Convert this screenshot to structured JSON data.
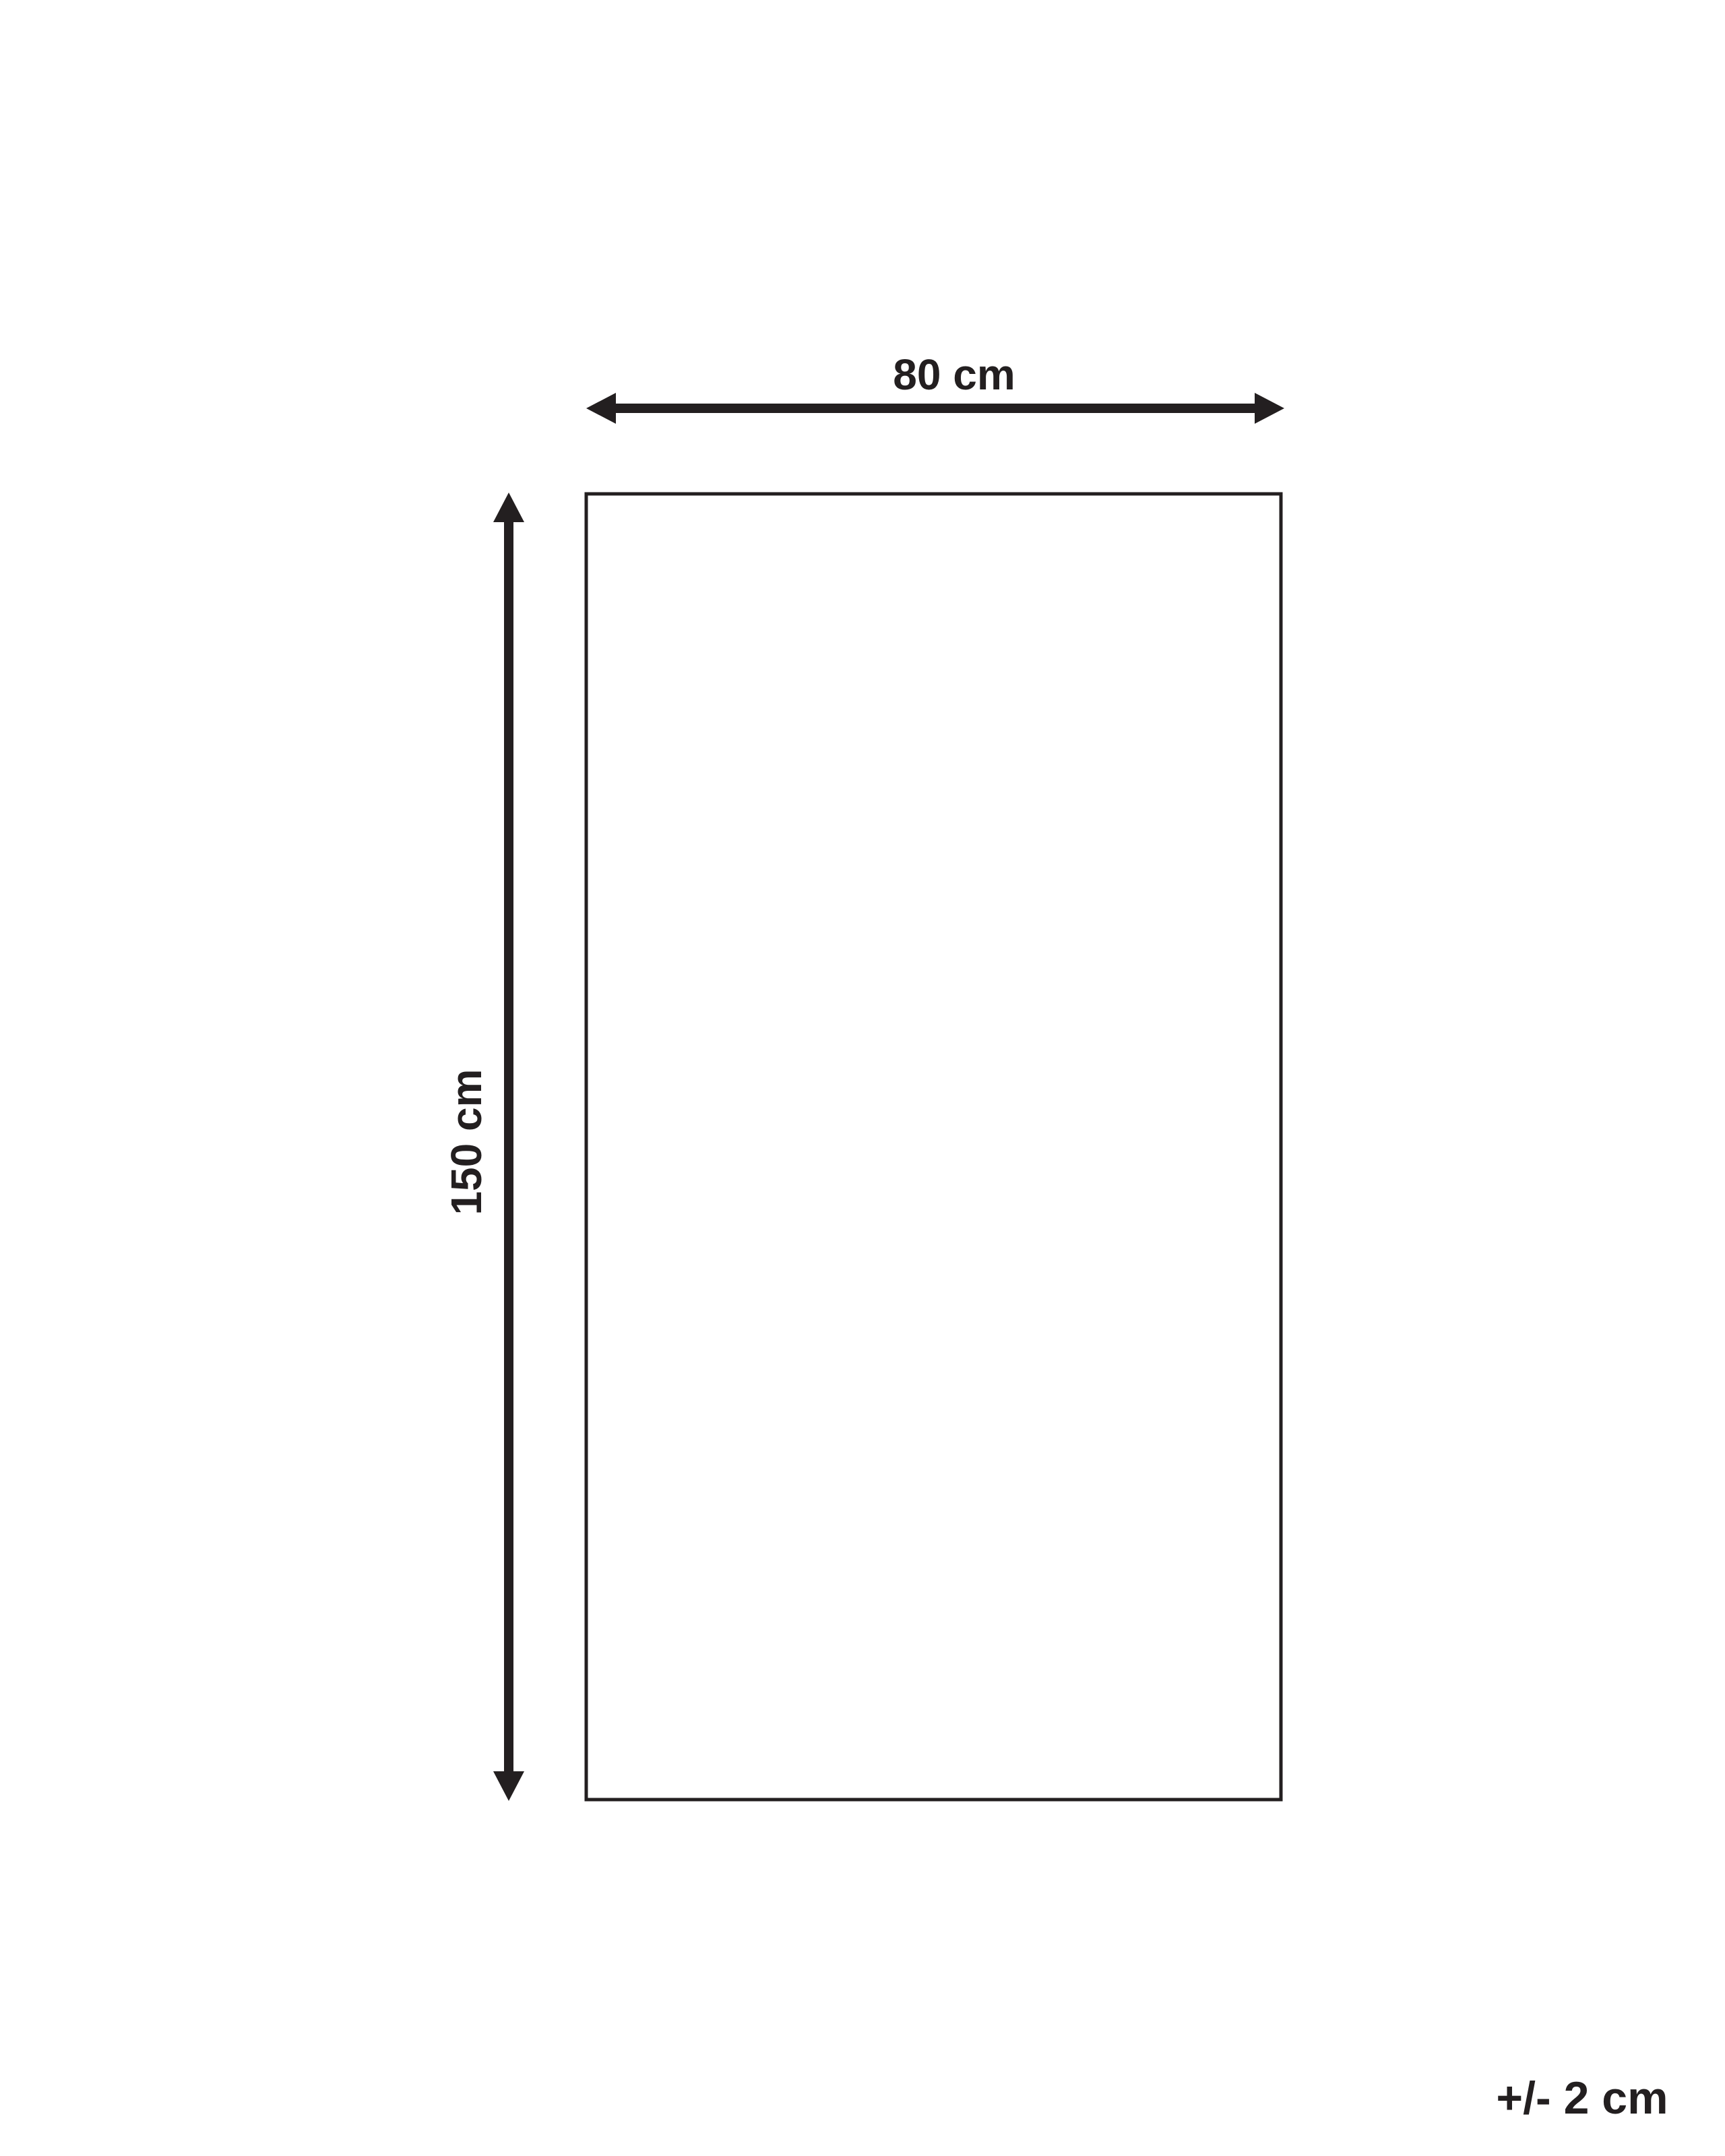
{
  "colors": {
    "ink": "#231f20",
    "background": "#ffffff"
  },
  "diagram": {
    "width_label": "80 cm",
    "height_label": "150 cm",
    "tolerance_label": "+/- 2 cm"
  }
}
